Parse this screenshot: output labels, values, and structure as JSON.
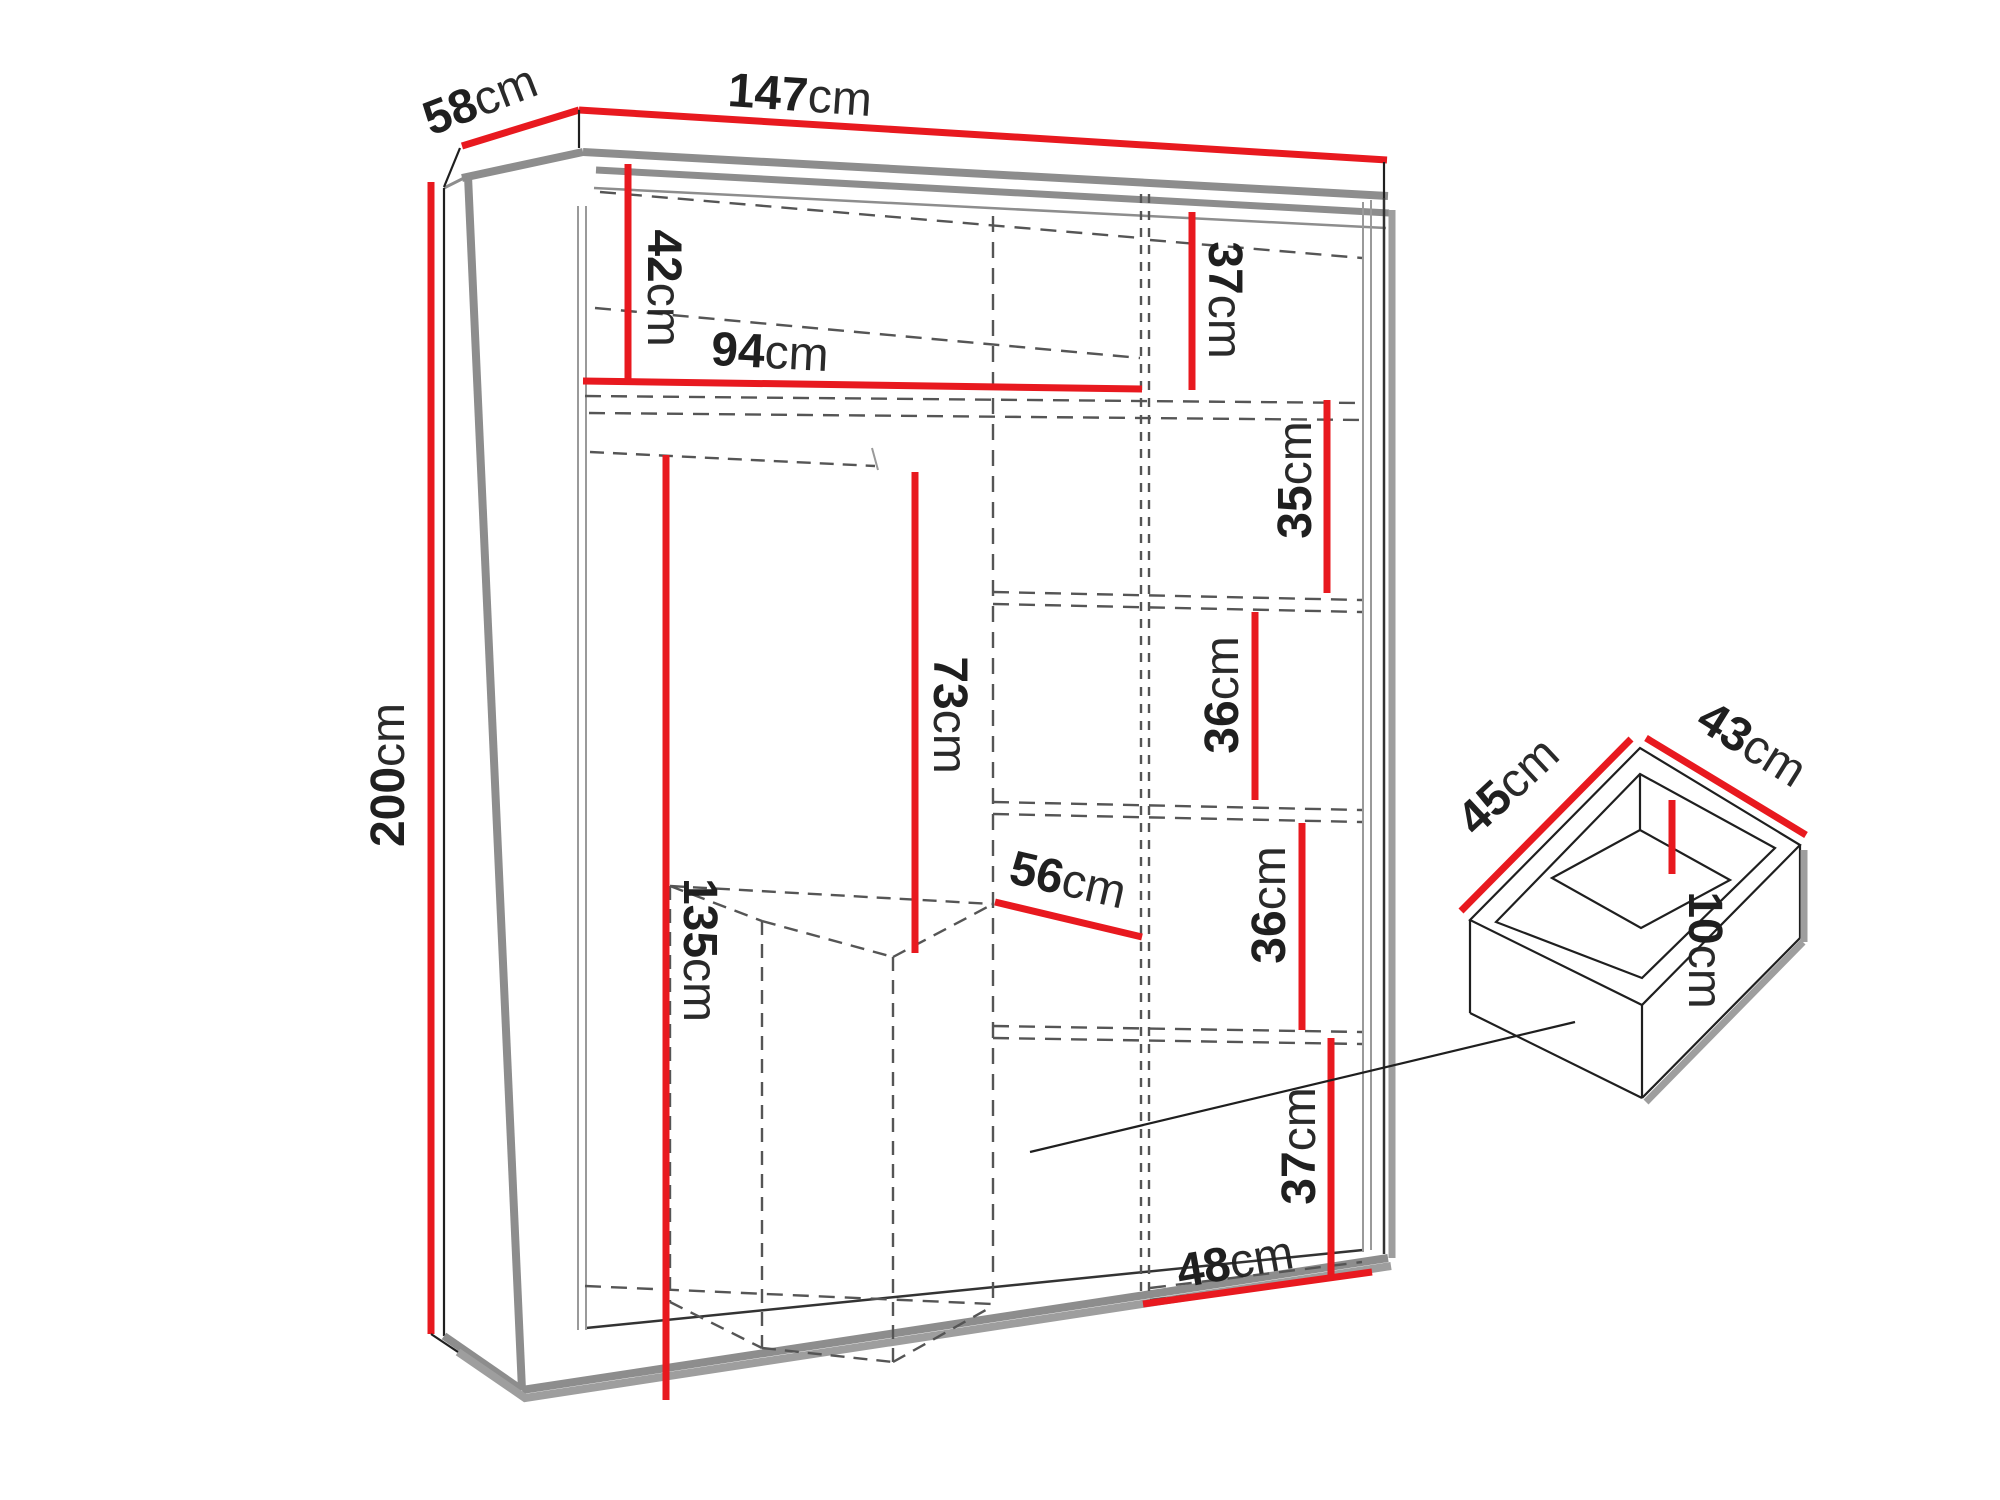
{
  "diagram": {
    "kind": "furniture-dimension-diagram",
    "colors": {
      "background": "#ffffff",
      "dimension_red": "#e8191f",
      "outline_gray": "#8d8d8d",
      "hidden_gray": "#555555",
      "shadow_gray": "#9e9e9e",
      "ink": "#1f1f1f"
    },
    "wardrobe": {
      "name": "wardrobe",
      "dimensions": [
        {
          "id": "depth",
          "value": "58",
          "unit": "cm"
        },
        {
          "id": "width",
          "value": "147",
          "unit": "cm"
        },
        {
          "id": "height",
          "value": "200",
          "unit": "cm"
        },
        {
          "id": "top-left-compartment-height",
          "value": "42",
          "unit": "cm"
        },
        {
          "id": "left-section-width",
          "value": "94",
          "unit": "cm"
        },
        {
          "id": "top-right-compartment-height",
          "value": "37",
          "unit": "cm"
        },
        {
          "id": "right-shelf-1-height",
          "value": "35",
          "unit": "cm"
        },
        {
          "id": "right-shelf-2-height",
          "value": "36",
          "unit": "cm"
        },
        {
          "id": "right-shelf-3-height",
          "value": "36",
          "unit": "cm"
        },
        {
          "id": "hanging-space-height",
          "value": "73",
          "unit": "cm"
        },
        {
          "id": "left-interior-height",
          "value": "135",
          "unit": "cm"
        },
        {
          "id": "middle-section-width",
          "value": "56",
          "unit": "cm"
        },
        {
          "id": "bottom-right-compartment-height",
          "value": "37",
          "unit": "cm"
        },
        {
          "id": "right-section-width",
          "value": "48",
          "unit": "cm"
        }
      ]
    },
    "drawer": {
      "name": "internal-drawer",
      "dimensions": [
        {
          "id": "drawer-width",
          "value": "45",
          "unit": "cm"
        },
        {
          "id": "drawer-depth",
          "value": "43",
          "unit": "cm"
        },
        {
          "id": "drawer-internal-height",
          "value": "10",
          "unit": "cm"
        }
      ]
    }
  }
}
